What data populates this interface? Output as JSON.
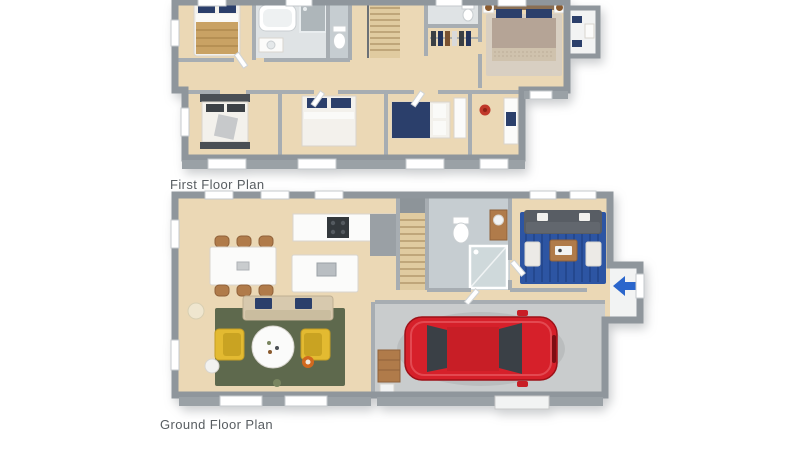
{
  "page": {
    "background": "#ffffff"
  },
  "plans": {
    "first_floor": {
      "label": "First Floor Plan",
      "objects": [
        "double-bed-tan",
        "bathtub",
        "shower",
        "toilet",
        "staircase",
        "ensuite-toilet",
        "walk-in-robe-clothes",
        "master-bed",
        "bedside-lamps",
        "balcony-furniture",
        "double-bed-dark",
        "double-bed-blue-pillows",
        "single-bed-navy",
        "desk",
        "red-desk-chair"
      ]
    },
    "ground_floor": {
      "label": "Ground Floor Plan",
      "objects": [
        "kitchen-counter",
        "cooktop",
        "kitchen-island-sink",
        "dining-table",
        "dining-chairs-x6",
        "staircase",
        "toilet",
        "vanity",
        "shower",
        "sectional-sofa",
        "blue-rug",
        "coffee-table",
        "entry-arrow",
        "fabric-sofa-blue-pillows",
        "green-rug",
        "yellow-armchair-left",
        "yellow-armchair-right",
        "round-coffee-table",
        "floor-lamp",
        "side-table",
        "red-car",
        "garage-shelf",
        "garage-door"
      ]
    }
  },
  "palette": {
    "page_bg": "#ffffff",
    "label_text": "#585d61",
    "wall": "#8f969c",
    "wall_light": "#a7adb2",
    "wall_face": "#9aa1a6",
    "floor_wood": "#ebd8b5",
    "floor_wood_dark": "#e0cba0",
    "floor_bath": "#dfe3e5",
    "floor_bath2": "#c6cdd1",
    "floor_garage": "#c9cccd",
    "floor_tile": "#f2f3f3",
    "rug_green": "#5e694d",
    "rug_blue": "#2d55a3",
    "rug_beige": "#d8cfc2",
    "sofa_dark": "#585d64",
    "armchair_yellow": "#e3ba31",
    "car_red": "#d6202a",
    "arrow_blue": "#2b66cc",
    "bed_navy": "#2b3f6b",
    "bed_tan": "#c9a264",
    "wood_furniture": "#b07b4a"
  }
}
